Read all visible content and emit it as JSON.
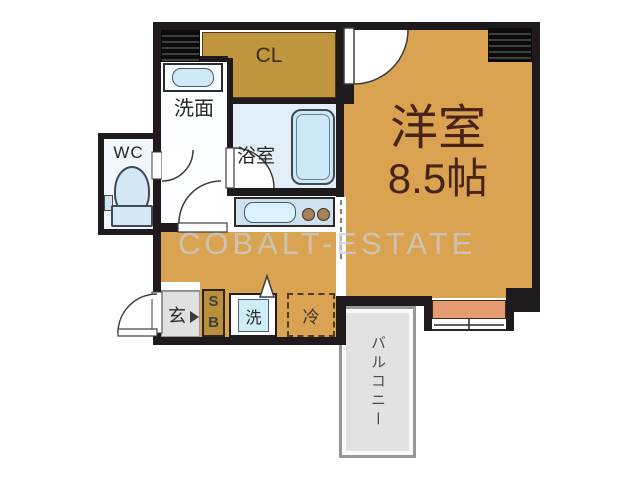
{
  "plan": {
    "watermark": "COBALT-ESTATE",
    "rooms": {
      "living": {
        "label": "洋室",
        "size": "8.5帖"
      },
      "closet": {
        "label": "CL"
      },
      "washroom": {
        "label": "洗面"
      },
      "wc": {
        "label": "WC"
      },
      "bathroom": {
        "label": "浴室"
      },
      "entrance": {
        "label": "玄"
      },
      "balcony": {
        "label": "バルコニー"
      }
    },
    "fixtures": {
      "shoebox": {
        "top": "S",
        "bottom": "B"
      },
      "washer": {
        "label": "洗"
      },
      "fridge": {
        "label": "冷"
      }
    },
    "colors": {
      "floor": "#d9a352",
      "closet": "#bf953e",
      "wall": "#1f1a1d",
      "bath": "#e1eef8",
      "fixture": "#cfeaf6",
      "counter": "#cfe0ee",
      "burner": "#a5825c",
      "tile": "#e0e0e0",
      "balcony_fill": "#e2e2e2",
      "balcony_border": "#979797",
      "salmon": "#e79b71",
      "living_text": "#4a2318",
      "label": "#262626",
      "line": "#3c3c3c",
      "watermark": "#cccccc"
    }
  }
}
